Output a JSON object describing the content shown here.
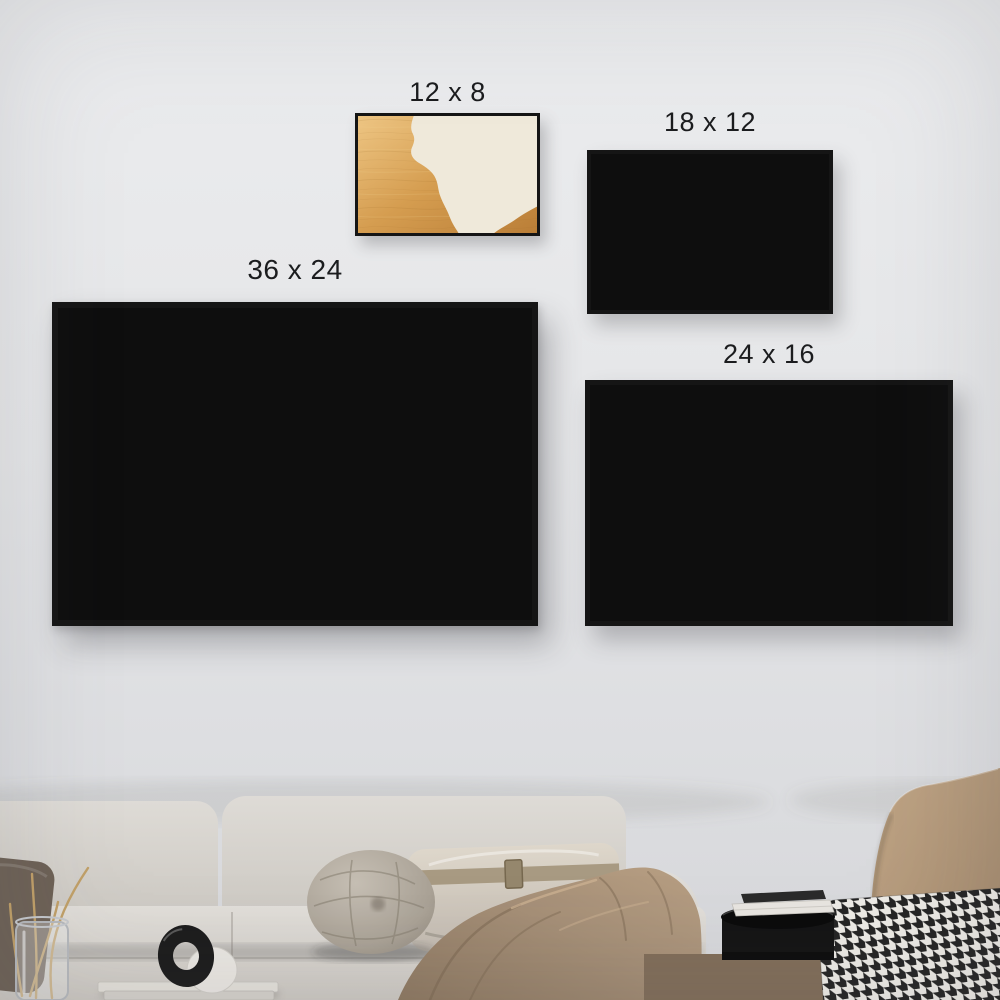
{
  "posters": [
    {
      "id": "12x8",
      "size_label": "12 x 8"
    },
    {
      "id": "18x12",
      "size_label": "18 x 12"
    },
    {
      "id": "36x24",
      "size_label": "36 x 24"
    },
    {
      "id": "24x16",
      "size_label": "24 x 16"
    }
  ],
  "artwork": {
    "title": "Family",
    "names": [
      "Daddy",
      "Mommy",
      "Sophia",
      "Charlie",
      "Ashley"
    ],
    "subtitle_lines": [
      "A LITTLE BIT OF CRAZY",
      "A LITTLE BIT OF LOUD",
      "& A WHOLE LOT OF"
    ],
    "love_word": "LOVE"
  },
  "palette": {
    "wall": "#e4e5e7",
    "frame": "#151515",
    "wood_light": "#ecc27d",
    "wood_dark": "#bd8038",
    "panel": "#efe9da",
    "heart_fill": "#f6f0e0",
    "ink": "#32281d",
    "skin": "#f5d9bc",
    "sofa": "#d5d2cd",
    "throw_blanket": "#a08a73",
    "armchair": "#b59c82",
    "pampas": "#d9bd8e"
  }
}
